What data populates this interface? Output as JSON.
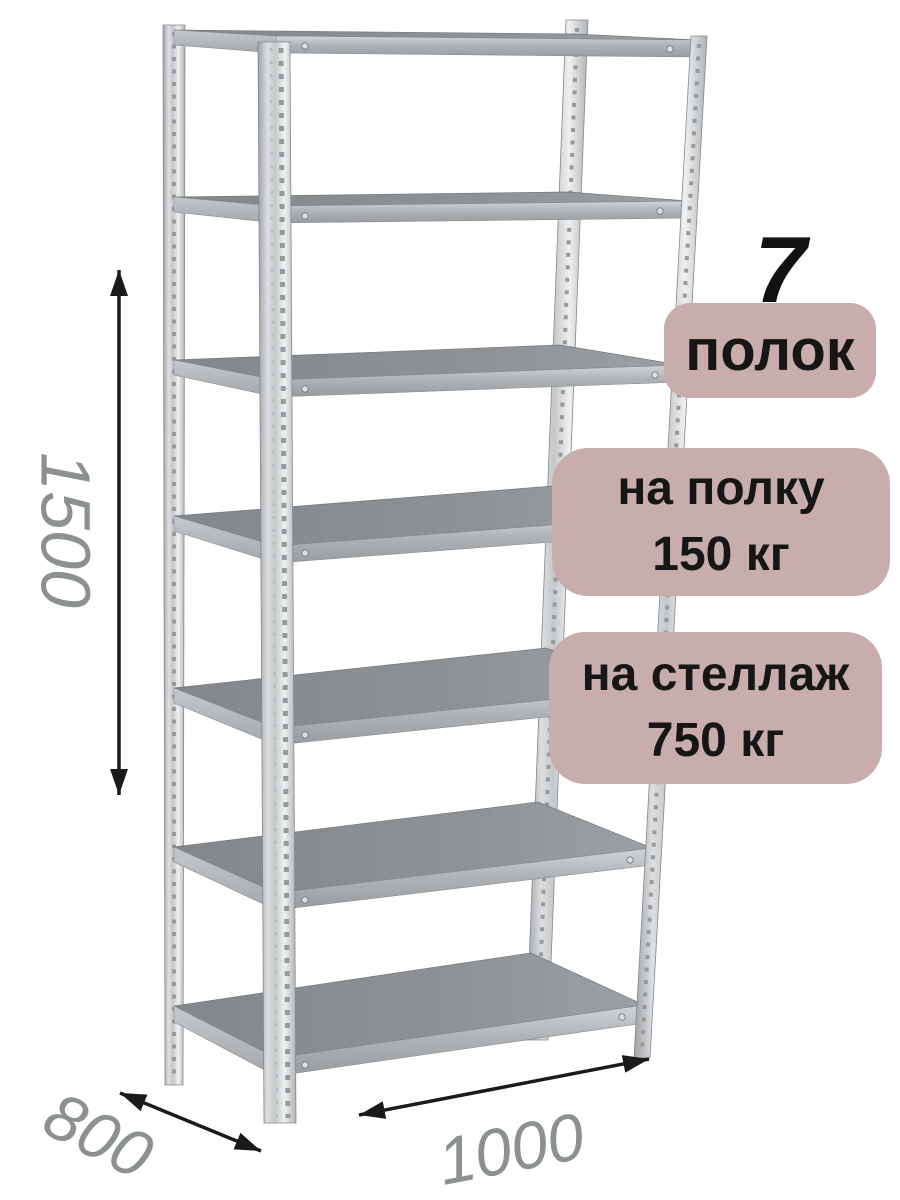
{
  "product": {
    "shelf_count": "7",
    "badges": {
      "shelves_label": "полок",
      "per_shelf_line1": "на полку",
      "per_shelf_line2": "150 кг",
      "per_rack_line1": "на стеллаж",
      "per_rack_line2": "750 кг"
    },
    "dimensions": {
      "height_mm": "1500",
      "depth_mm": "800",
      "width_mm": "1000"
    },
    "colors": {
      "badge_bg": "#c9adad",
      "badge_text": "#161616",
      "dim_label": "#8b9091",
      "arrow": "#1a1a1a",
      "metal_light": "#e8eaeb",
      "metal_mid": "#b4b7ba",
      "shelf_top": "#85898c"
    }
  }
}
